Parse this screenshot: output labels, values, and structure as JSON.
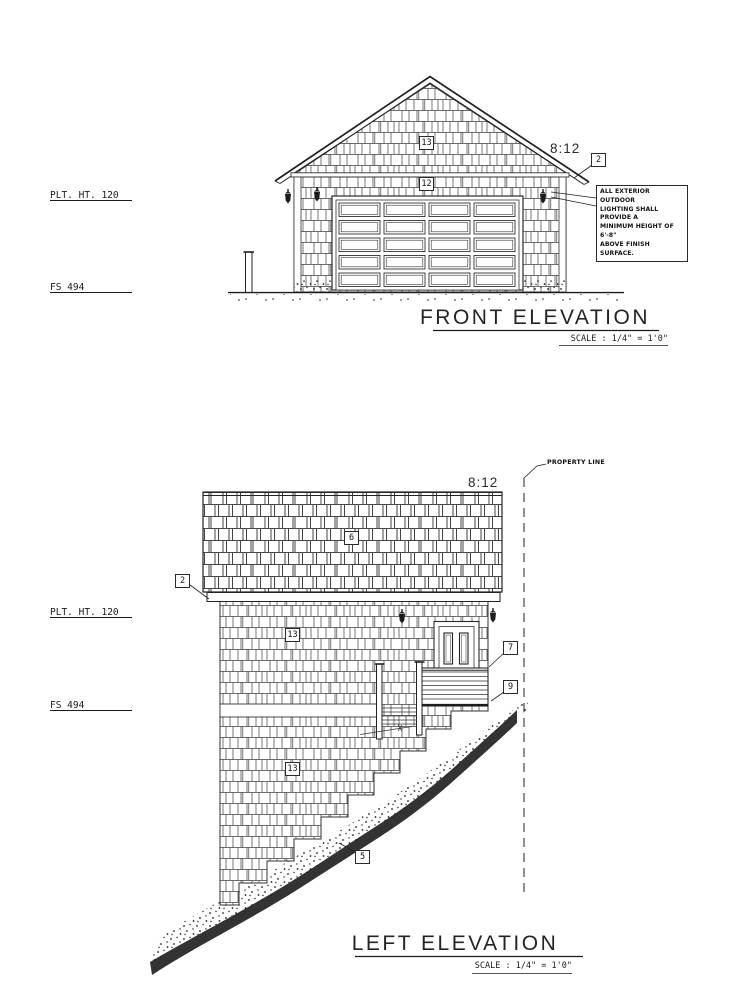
{
  "front_elevation": {
    "title": "FRONT ELEVATION",
    "scale_label": "SCALE : 1/4\" = 1'0\"",
    "roof_pitch": "8:12",
    "plate_height": "PLT. HT. 120",
    "finish_surface": "FS 494",
    "callouts": {
      "roof_edge": "2",
      "gable_siding": "13",
      "wall_siding": "12"
    },
    "lighting_note": [
      "ALL EXTERIOR OUTDOOR",
      "LIGHTING SHALL PROVIDE A",
      "MINIMUM HEIGHT OF 6'-8\"",
      "ABOVE FINISH SURFACE."
    ]
  },
  "left_elevation": {
    "title": "LEFT ELEVATION",
    "scale_label": "SCALE : 1/4\" = 1'0\"",
    "roof_pitch": "8:12",
    "plate_height": "PLT. HT. 120",
    "finish_surface": "FS 494",
    "property_line": "PROPERTY LINE",
    "callouts": {
      "roof_edge": "2",
      "roof_shingles": "6",
      "wall_siding_upper": "13",
      "wall_siding_lower": "13",
      "deck_rail": "7",
      "grade": "9",
      "footing": "5"
    }
  }
}
